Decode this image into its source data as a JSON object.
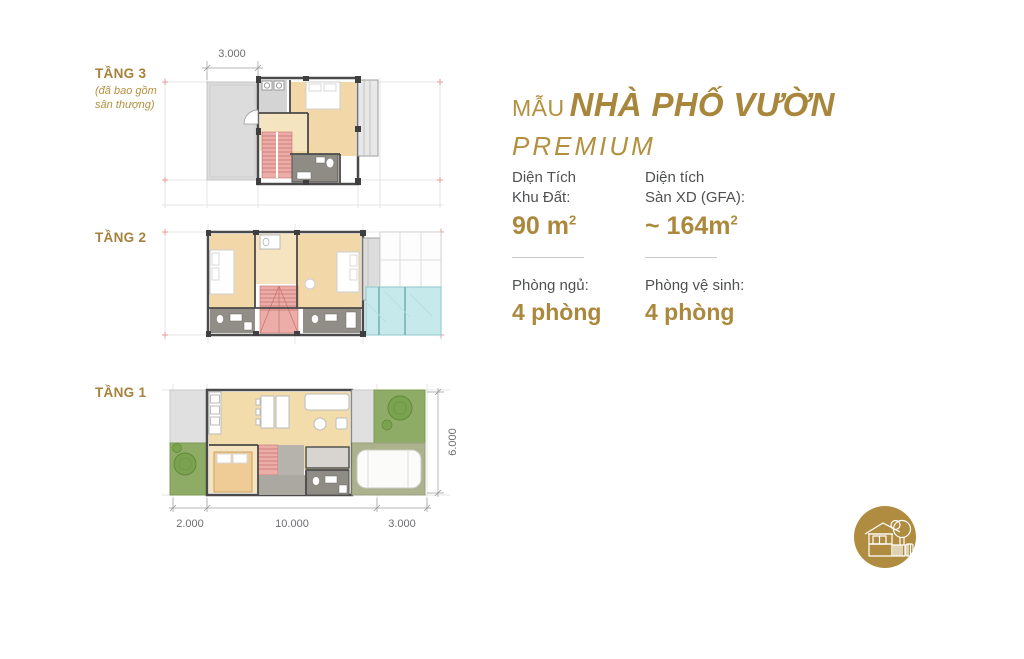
{
  "brand": {
    "accent_gold": "#AB883C",
    "label_gold": "#A5823A",
    "text_dark": "#4F5052",
    "dim_text": "#6D6E71"
  },
  "floors": [
    {
      "label": "TẦNG 3",
      "note_line1": "(đã bao gồm",
      "note_line2": "sân thượng)",
      "dim_top": "3.000"
    },
    {
      "label": "TẦNG 2"
    },
    {
      "label": "TẦNG 1",
      "dim_right": "6.000",
      "dim_bottom_1": "2.000",
      "dim_bottom_2": "10.000",
      "dim_bottom_3": "3.000"
    }
  ],
  "info": {
    "title_prefix": "MẪU",
    "title_main": "NHÀ PHỐ VƯỜN",
    "subtitle": "PREMIUM",
    "specs": [
      {
        "label_line1": "Diện Tích",
        "label_line2": "Khu Đất:",
        "value": "90 m",
        "value_sup": "2"
      },
      {
        "label_line1": "Diện tích",
        "label_line2": "Sàn XD (GFA):",
        "value": "~ 164m",
        "value_sup": "2"
      },
      {
        "label_line1": "Phòng ngủ:",
        "label_line2": "",
        "value": "4 phòng",
        "value_sup": ""
      },
      {
        "label_line1": "Phòng vệ sinh:",
        "label_line2": "",
        "value": "4 phòng",
        "value_sup": ""
      }
    ]
  },
  "logo": {
    "icon": "house-with-tree"
  }
}
